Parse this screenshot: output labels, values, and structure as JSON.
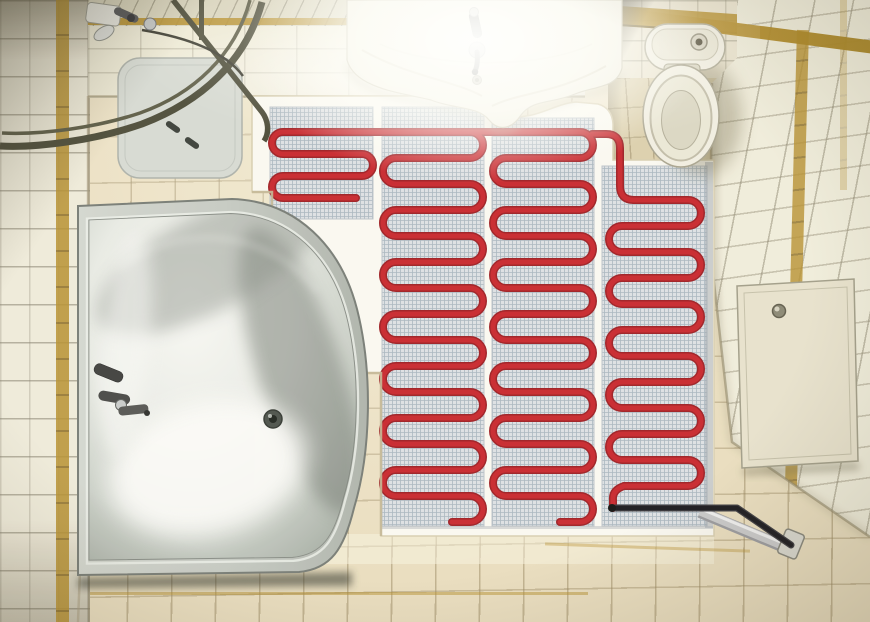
{
  "scene": {
    "description": "Top-down view of a small bathroom: corner shower, vanity sink, toilet niche, acrylic corner bathtub, and electric underfloor heating mats (red serpentine cable on grey mesh over white underlay) with a black cold lead running to a wall connection behind a service panel wall.",
    "view": "top-down",
    "objects": [
      {
        "name": "shower-enclosure",
        "label": "Corner shower with curved dark rail and grey tray"
      },
      {
        "name": "vanity-sink",
        "label": "Wall-hung vanity basin with chrome faucet"
      },
      {
        "name": "toilet",
        "label": "Toilet with cistern in tiled niche"
      },
      {
        "name": "corner-bathtub",
        "label": "Acrylic corner bathtub with chrome mixer and drain"
      },
      {
        "name": "heating-mat",
        "label": "Electric underfloor heating mat strips with red cable serpentine"
      },
      {
        "name": "cold-lead-cable",
        "label": "Black supply lead routed through silver conduit to wall plate"
      },
      {
        "name": "access-panel",
        "label": "Cream service access panel on right wall"
      },
      {
        "name": "tile-steps",
        "label": "Stair-stepped beige floor tiles along bathtub curve"
      }
    ]
  },
  "palette": {
    "floor_tile": "#eadfc1",
    "floor_line": "#96845e",
    "wall_tile": "#f0ecdc",
    "wall_line": "#8b8570",
    "gold": "#b68f2d",
    "ceiling": "#d9d5bf",
    "underlay": "#fbfaf4",
    "mesh_bg": "#dde2e6",
    "mesh_line": "#a9b7c1",
    "mesh_edge": "#bcc4cb",
    "cable_red": "#c8262d",
    "cable_dark": "#9e1d24",
    "lead": "#17171d",
    "conduit": "#c9cacc",
    "tub_shell": "#c2c7c0",
    "porcelain": "#f2f0e4",
    "rail": "#4c4c3a",
    "niche_floor": "#dcd1af",
    "panel": "#e8e3cf"
  },
  "heating_mat": {
    "type": "serpentine-cable-mat",
    "underlay_path": "M252,96 L438,96 C468,96 478,112 504,116 C536,121 552,104 576,102 L598,104 Q612,108 613,124 L613,160 L714,160 L714,536 L381,536 L381,373 L356,373 L356,328 L328,328 L328,283 L300,283 L300,238 L272,238 L272,192 L252,192 Z",
    "steps_edge_path": "M381,536 L381,373 L356,373 L356,328 L328,328 L328,283 L300,283 L300,238 L272,238 L272,192 L252,192",
    "strips": [
      {
        "id": "strip-1",
        "x": 270,
        "y": 107,
        "w": 103,
        "h": 112,
        "cable": {
          "sx": 486,
          "x0": 283,
          "x1": 362,
          "ys": 132,
          "gap": 22,
          "n": 4,
          "dir0": "L",
          "endX": 356
        }
      },
      {
        "id": "strip-2",
        "x": 382,
        "y": 107,
        "w": 102,
        "h": 419,
        "cable": {
          "sx": 382,
          "x0": 396,
          "x1": 470,
          "ys": 132,
          "gap": 26,
          "n": 16,
          "dir0": "R",
          "endX": 452
        }
      },
      {
        "id": "strip-3",
        "x": 492,
        "y": 118,
        "w": 102,
        "h": 408,
        "cable": {
          "sx": 492,
          "x0": 506,
          "x1": 580,
          "ys": 132,
          "gap": 26,
          "n": 16,
          "dir0": "R",
          "endX": 560
        }
      },
      {
        "id": "strip-4",
        "x": 602,
        "y": 166,
        "w": 105,
        "h": 360,
        "cable": {
          "sx": 634,
          "x0": 622,
          "x1": 688,
          "ys": 200,
          "gap": 26,
          "n": 12,
          "dir0": "R",
          "endX": 624
        }
      }
    ],
    "extra_cable_segments": [
      "M592,134 L606,134 Q620,134 620,148 L620,186 Q620,200 634,200",
      "M624,486 Q612,490 613,500 L613,508",
      "M468,132 L494,132"
    ],
    "cold_lead_path": "M613,508 L737,508 L791,545"
  }
}
